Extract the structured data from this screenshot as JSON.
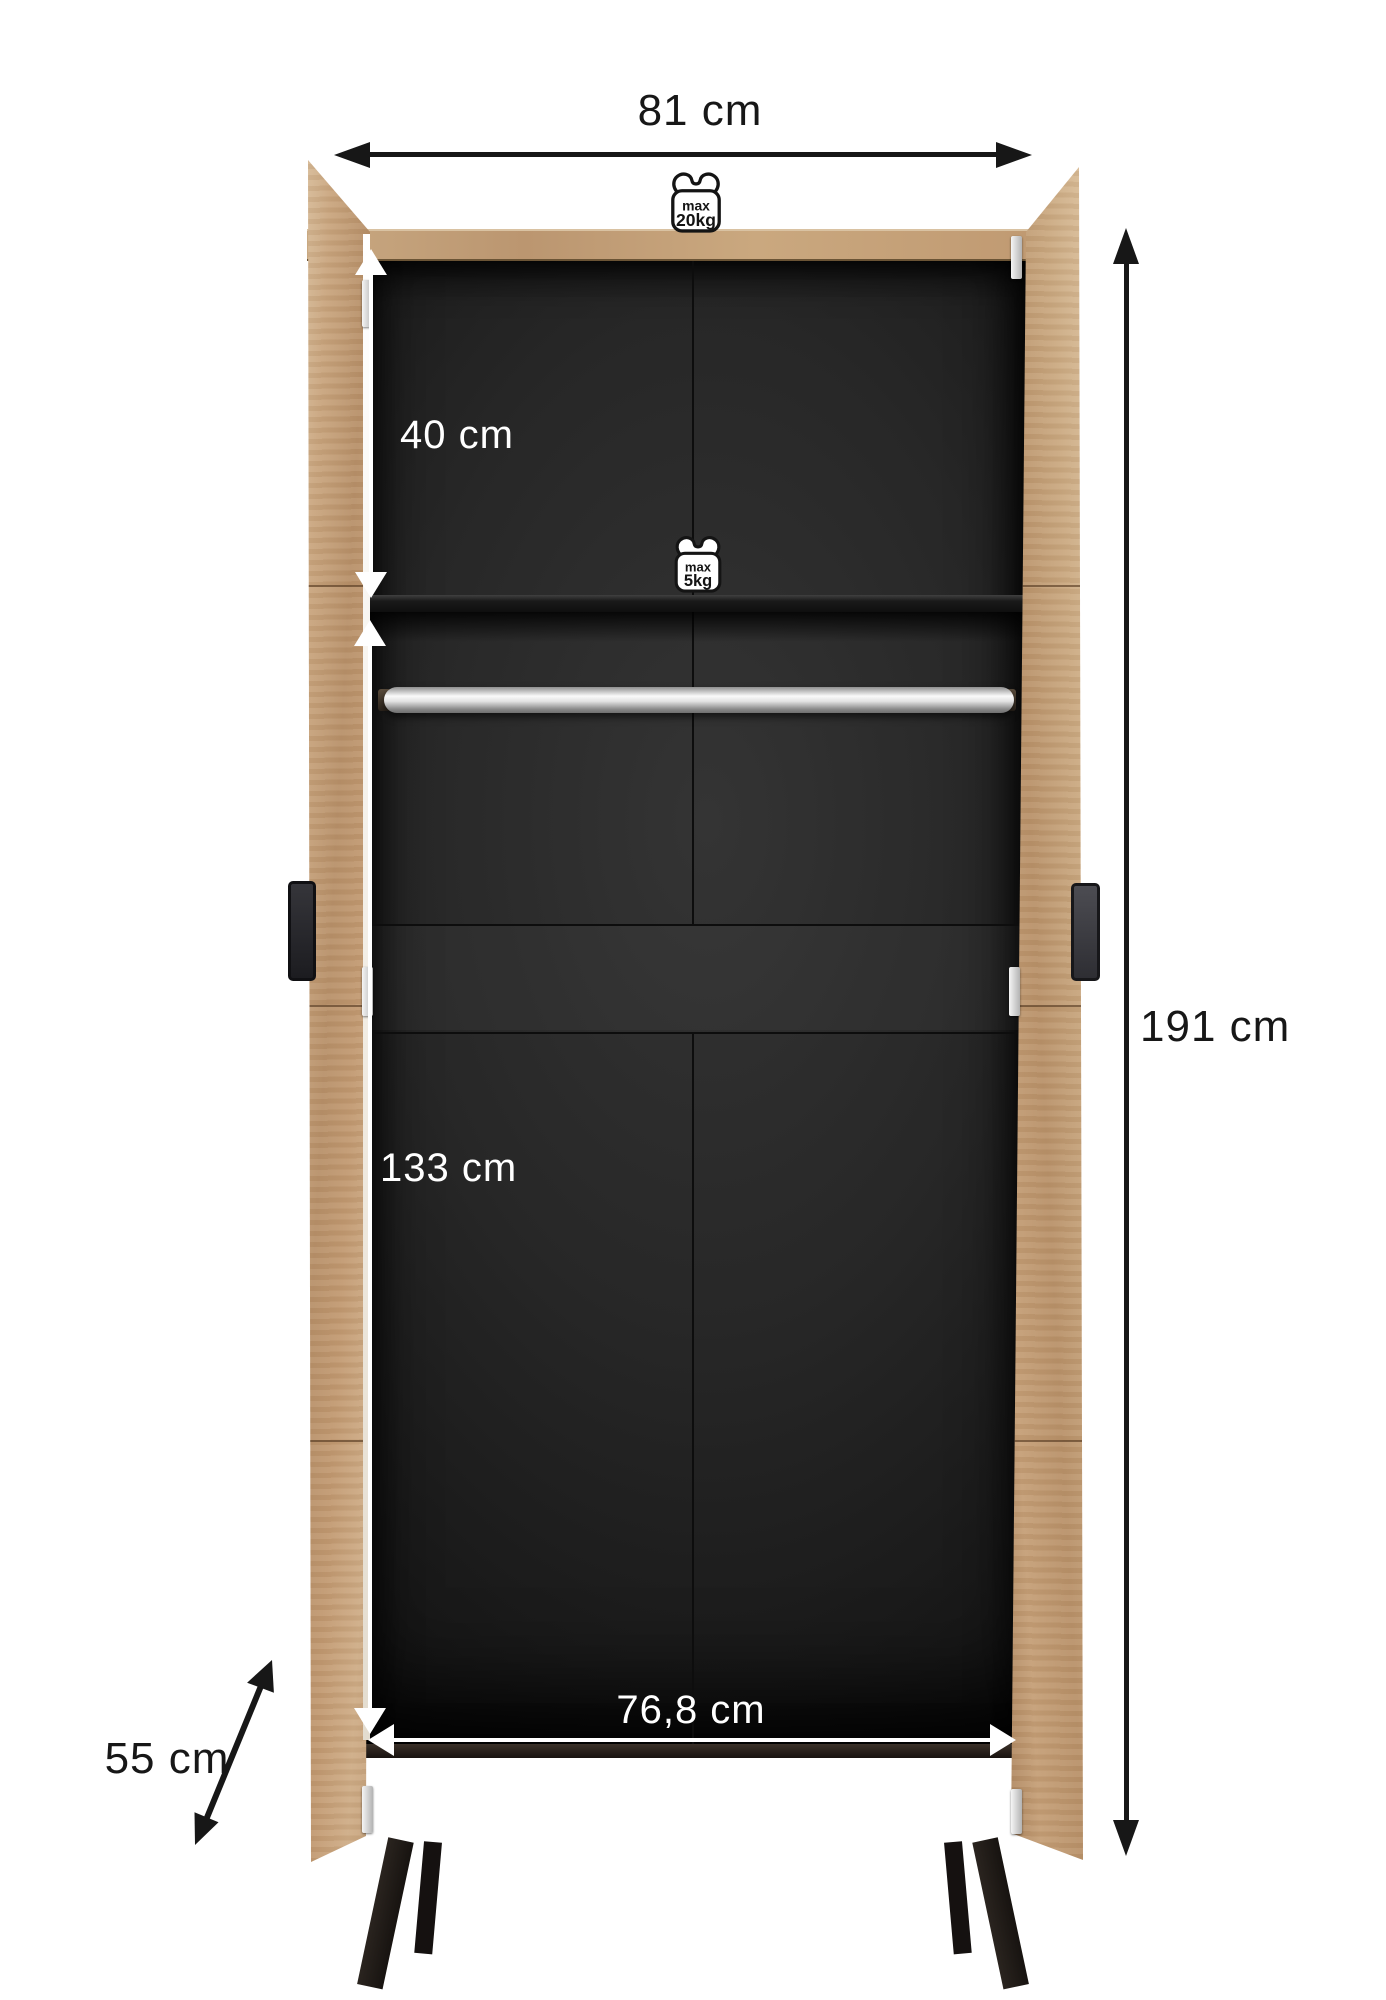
{
  "diagram": {
    "subject": "two-door wardrobe open front view with dimensions",
    "dimensions": {
      "width": "81 cm",
      "height": "191 cm",
      "upper_section_height": "40 cm",
      "lower_section_height": "133 cm",
      "inner_width": "76,8 cm",
      "depth": "55 cm"
    },
    "load_limits": {
      "top_panel": {
        "prefix": "max",
        "value": "20kg"
      },
      "shelf": {
        "prefix": "max",
        "value": "5kg"
      }
    },
    "colors": {
      "wood": "#c2a07a",
      "interior_dark": "#1c1c1c",
      "dimension_black": "#171717",
      "dimension_white": "#ffffff"
    }
  }
}
